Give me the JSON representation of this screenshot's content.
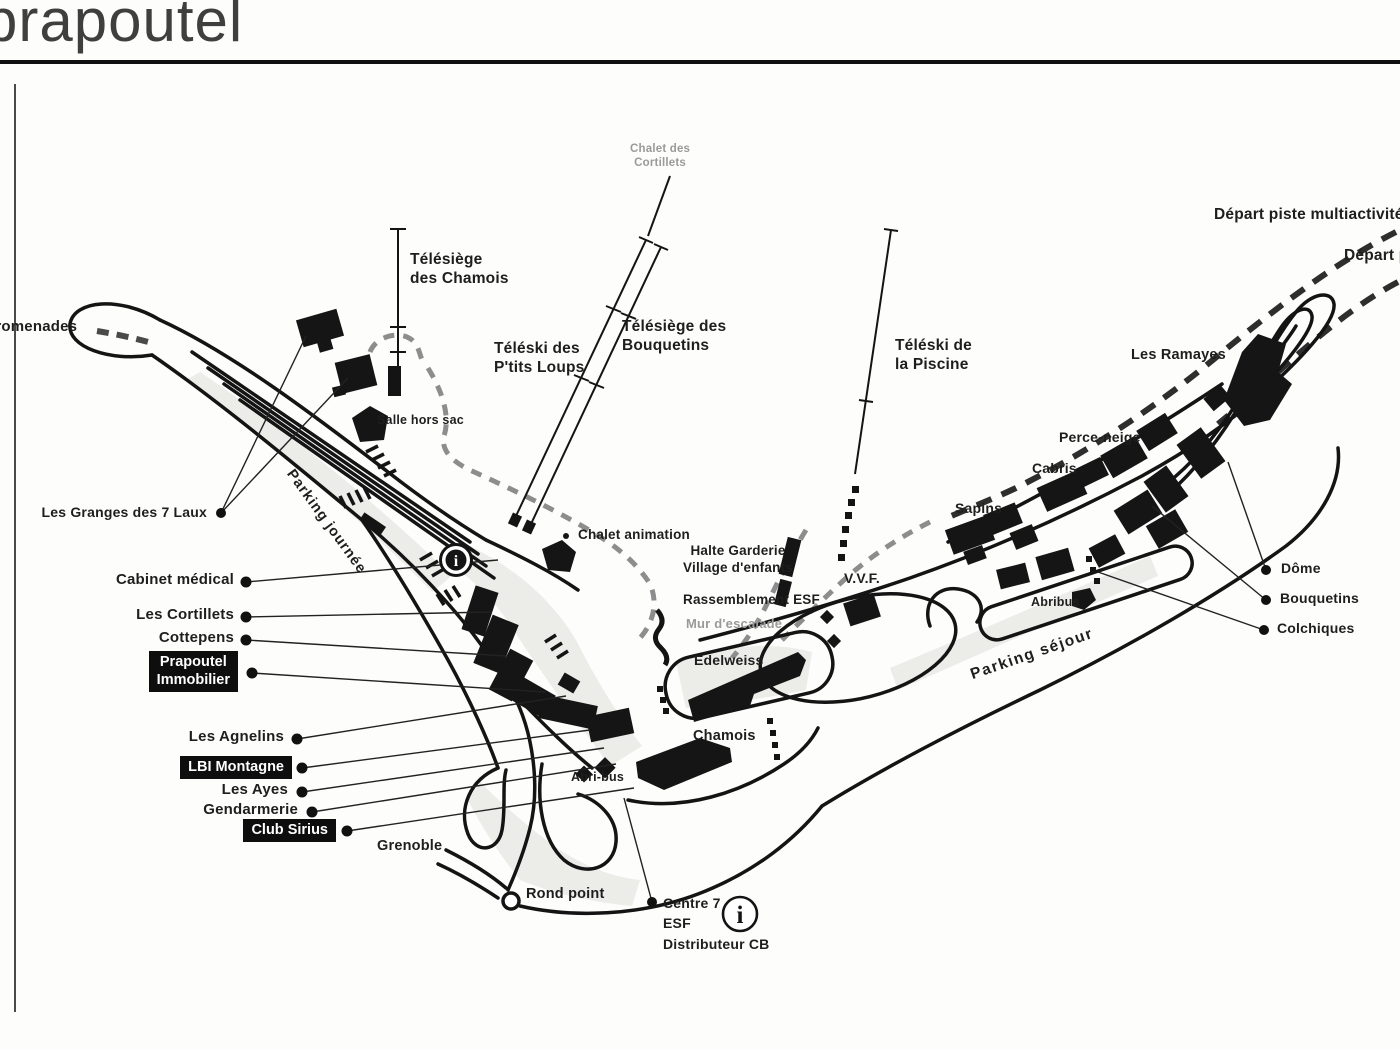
{
  "title": "prapoutel",
  "colors": {
    "ink": "#141414",
    "box_bg": "#0e0e0e",
    "gray_text": "#9a9a9a"
  },
  "labels": {
    "promenades": "promenades",
    "chalet_cortillets_1": "Chalet des",
    "chalet_cortillets_2": "Cortillets",
    "telesiege_chamois_1": "Télésiège",
    "telesiege_chamois_2": "des Chamois",
    "teleski_ptits_loups_1": "Téléski des",
    "teleski_ptits_loups_2": "P'tits Loups",
    "telesiege_bouquetins_1": "Télésiège des",
    "telesiege_bouquetins_2": "Bouquetins",
    "teleski_piscine_1": "Téléski de",
    "teleski_piscine_2": "la Piscine",
    "depart_piste_multiactivite": "Départ piste multiactivité",
    "depart_piste": "Départ piste",
    "les_ramayes": "Les Ramayes",
    "perce_neige": "Perce-neige",
    "cabris": "Cabris",
    "sapins": "Sapins",
    "salle_hors_sac": "Salle hors sac",
    "les_granges": "Les Granges des 7 Laux",
    "chalet_animation": "Chalet animation",
    "halte_garderie_1": "Halte Garderie",
    "halte_garderie_2": "Village d'enfants",
    "rassemblement_esf": "Rassemblement ESF",
    "mur_escalade": "Mur d'escalade",
    "vvf": "V.V.F.",
    "edelweiss": "Edelweiss",
    "chamois": "Chamois",
    "abri_bus": "Abri-bus",
    "abribus": "Abribus",
    "parking_sejour": "Parking séjour",
    "parking_journee": "Parking journée",
    "dome": "Dôme",
    "bouquetins": "Bouquetins",
    "colchiques": "Colchiques",
    "cabinet_medical": "Cabinet médical",
    "les_cortillets": "Les Cortillets",
    "cottepens": "Cottepens",
    "prapoutel_immobilier_1": "Prapoutel",
    "prapoutel_immobilier_2": "Immobilier",
    "les_agnelins": "Les Agnelins",
    "lbi_montagne": "LBI Montagne",
    "les_ayes": "Les Ayes",
    "gendarmerie": "Gendarmerie",
    "club_sirius": "Club Sirius",
    "grenoble": "Grenoble",
    "rond_point": "Rond point",
    "centre7_1": "Centre 7",
    "centre7_2": "ESF",
    "centre7_3": "Distributeur CB",
    "info_icon": "i"
  }
}
